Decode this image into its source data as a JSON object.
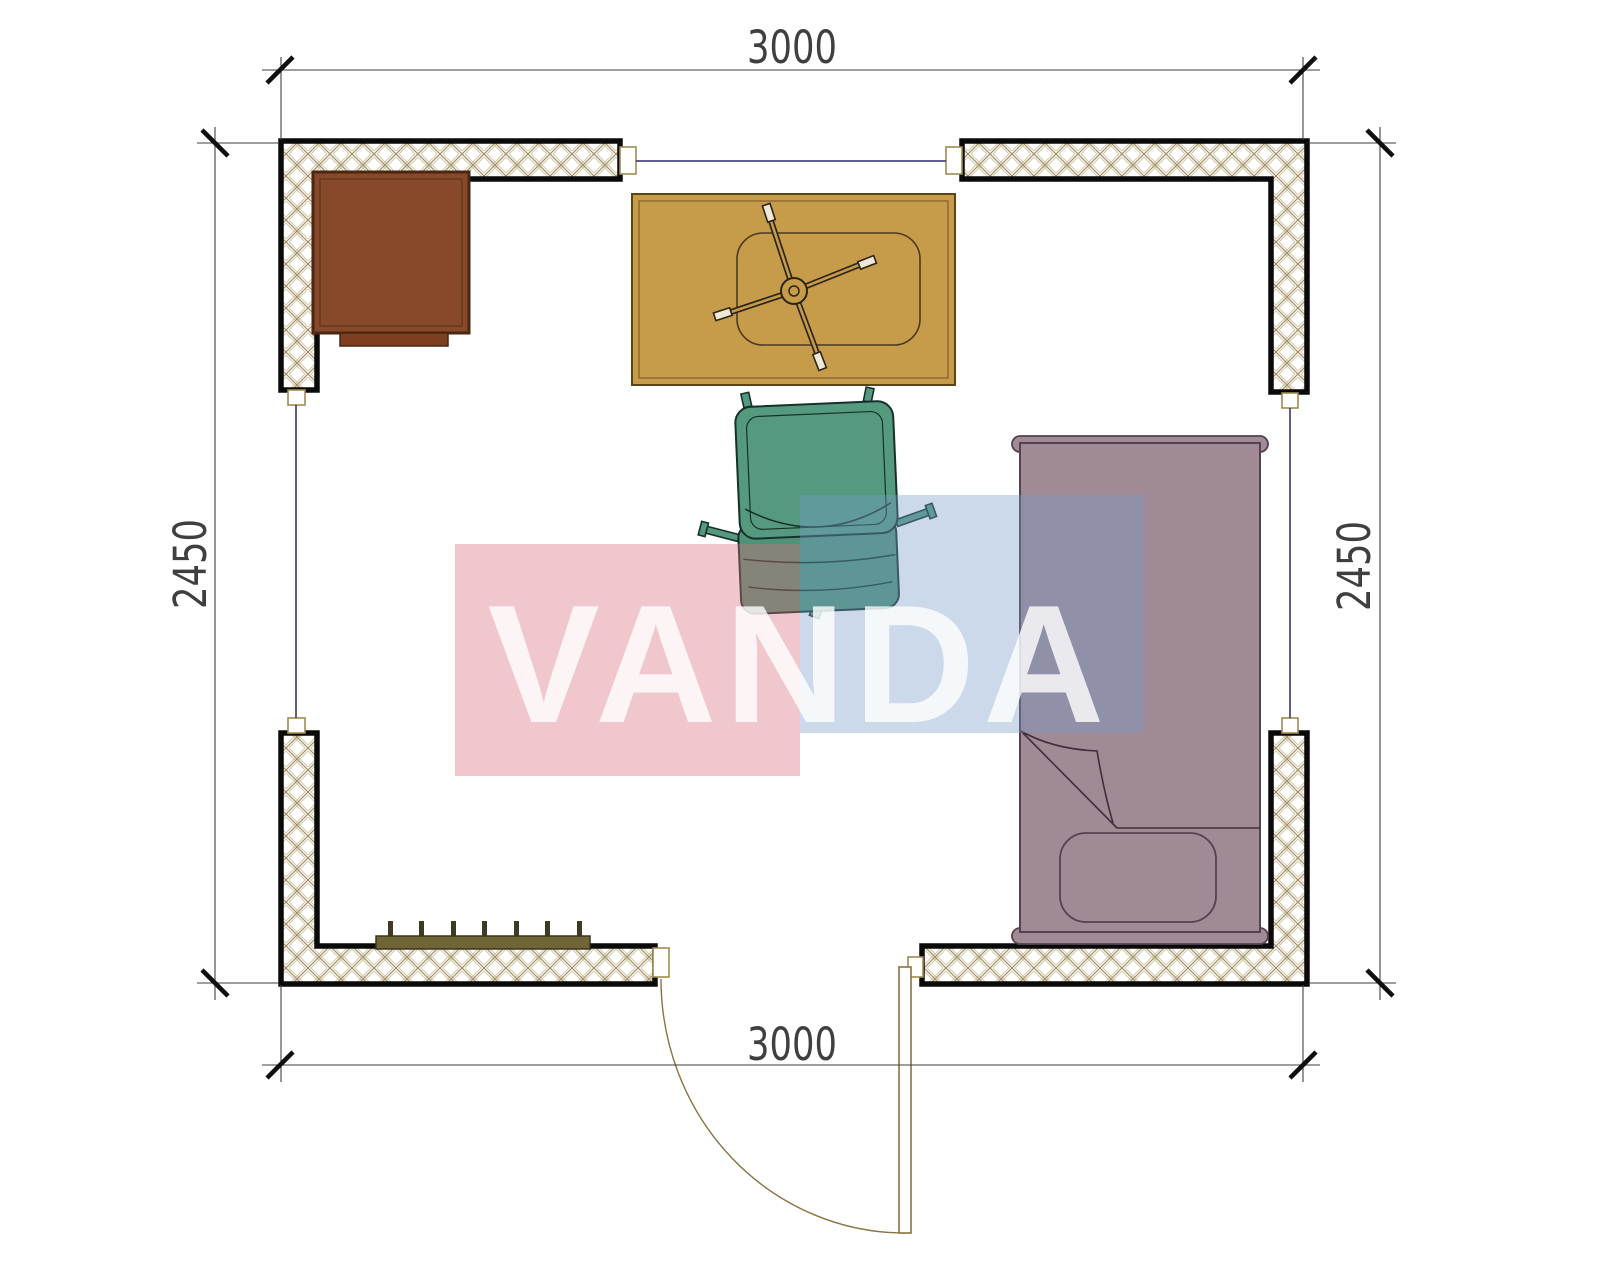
{
  "drawing": {
    "kind": "floor-plan",
    "dimensions": {
      "top_width": "3000",
      "bottom_width": "3000",
      "left_height": "2450",
      "right_height": "2450"
    },
    "watermark": {
      "text": "VANDA",
      "pink_color": "rgba(218,109,126,0.38)",
      "blue_color": "rgba(118,155,200,0.38)",
      "text_color": "rgba(255,255,255,0.80)"
    },
    "colors": {
      "wall_outline": "#0a0a0a",
      "wall_hatch": "#a3926a",
      "window_line": "#2b2b6b",
      "door_line": "#8a7340",
      "dimension_line": "#3f3f3f",
      "cabinet": "#87492a",
      "cabinet_base": "#7d3f20",
      "desk": "#c69b4a",
      "chair_seat": "#55997e",
      "chair_back": "#4f9377",
      "bed": "#a08a95",
      "radiator": "#6f6537",
      "radiator_tick": "#3f3a22"
    }
  }
}
